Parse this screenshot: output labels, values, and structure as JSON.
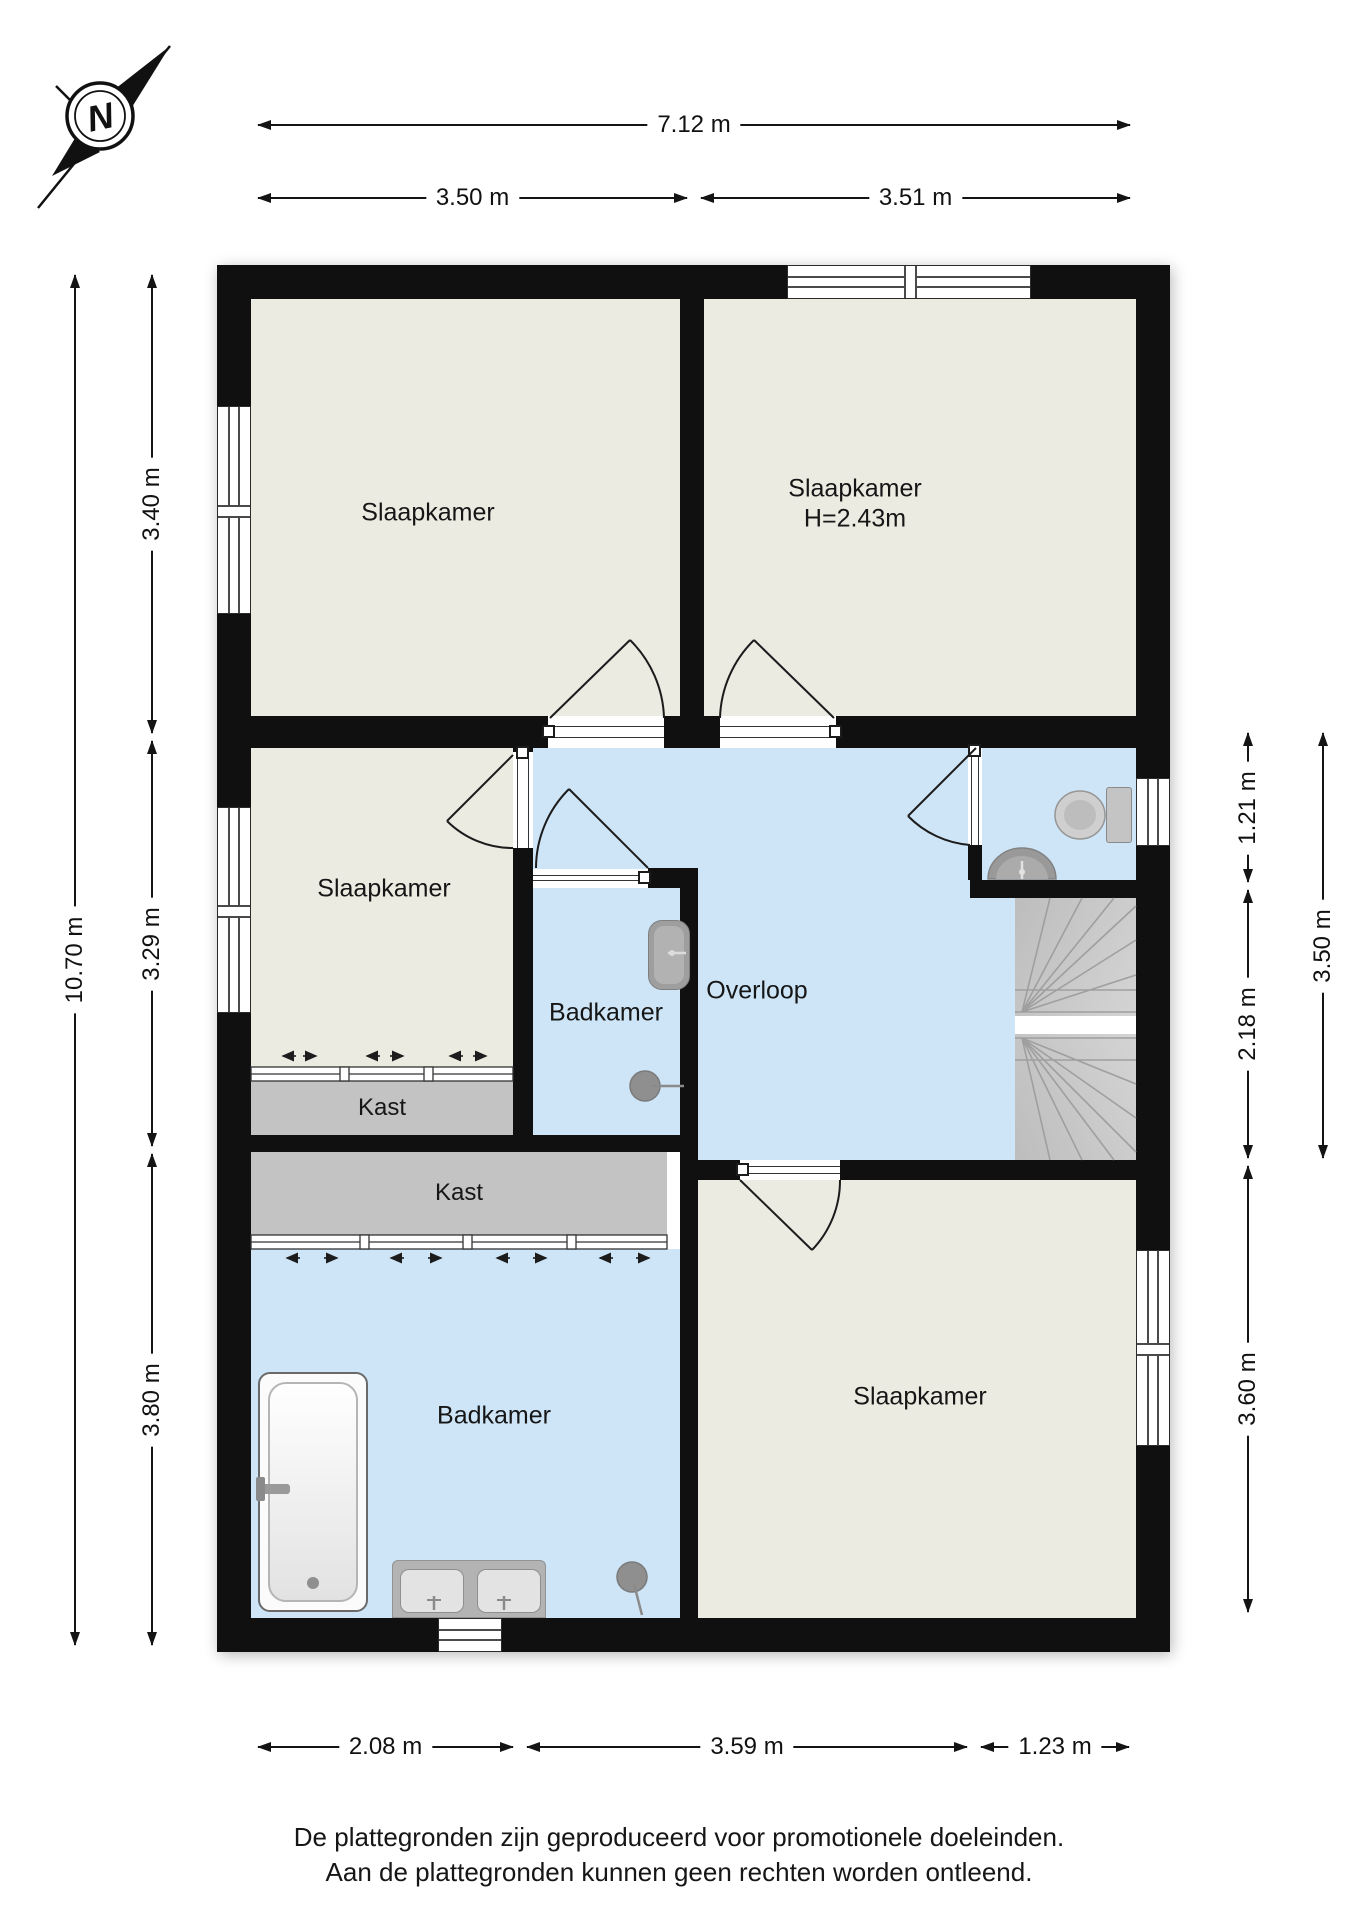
{
  "compass": {
    "letter": "N"
  },
  "rooms": {
    "bedroom_top_left": {
      "label": "Slaapkamer"
    },
    "bedroom_top_right": {
      "label": "Slaapkamer",
      "height_note": "H=2.43m"
    },
    "bedroom_middle_left": {
      "label": "Slaapkamer"
    },
    "bedroom_bottom_right": {
      "label": "Slaapkamer"
    },
    "landing": {
      "label": "Overloop"
    },
    "bathroom_small": {
      "label": "Badkamer"
    },
    "bathroom_large": {
      "label": "Badkamer"
    },
    "closet_upper": {
      "label": "Kast"
    },
    "closet_lower": {
      "label": "Kast"
    }
  },
  "dimensions": {
    "top": {
      "total": "7.12 m",
      "left": "3.50 m",
      "right": "3.51 m"
    },
    "left": {
      "total": "10.70 m",
      "top": "3.40 m",
      "middle": "3.29 m",
      "bottom": "3.80 m"
    },
    "right": {
      "toilet": "1.21 m",
      "stairs": "2.18 m",
      "combined": "3.50 m",
      "bedroom": "3.60 m"
    },
    "bottom": {
      "left": "2.08 m",
      "middle": "3.59 m",
      "right": "1.23 m"
    }
  },
  "footer": {
    "line1": "De plattegronden zijn geproduceerd voor promotionele doeleinden.",
    "line2": "Aan de plattegronden kunnen geen rechten worden ontleend."
  },
  "colors": {
    "wall": "#101010",
    "room_floor": "#ECEBE2",
    "wet_floor": "#CDE5F7",
    "closet": "#C3C3C3",
    "stairs": "#C9C9C9",
    "background": "#FFFFFF"
  }
}
